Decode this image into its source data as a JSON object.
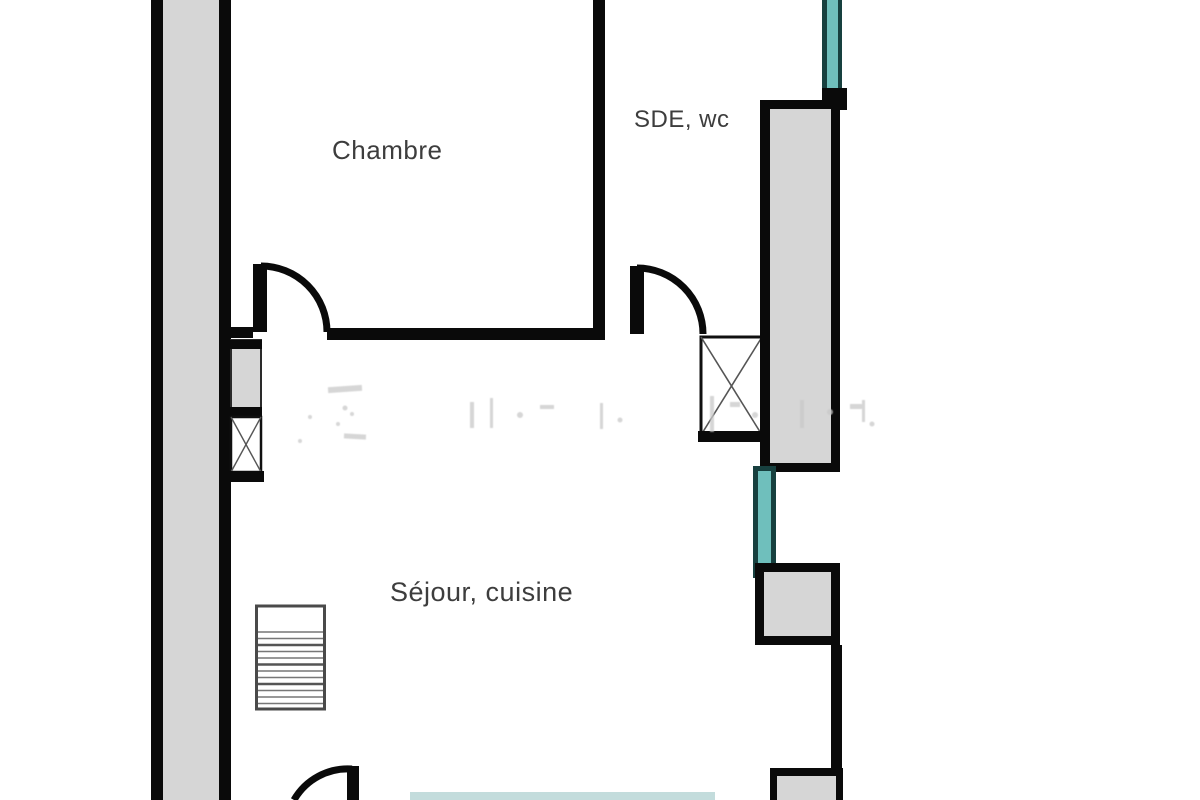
{
  "plan": {
    "type": "floor-plan",
    "rooms": [
      {
        "id": "chambre",
        "label": "Chambre"
      },
      {
        "id": "sde",
        "label": "SDE, wc"
      },
      {
        "id": "sejour",
        "label": "Séjour, cuisine"
      }
    ]
  },
  "colors": {
    "wall_black": "#0a0a0a",
    "wall_gray": "#d6d6d6",
    "window_teal": "#6fbfbc",
    "window_dark": "#17403f",
    "window_pale": "#b9d6d6",
    "label_gray": "#3d3d3d",
    "stairs_border": "#4a4a4a",
    "stairs_line": "#777777",
    "wm_gray": "#c9c9c9",
    "page_bg": "#ffffff"
  }
}
